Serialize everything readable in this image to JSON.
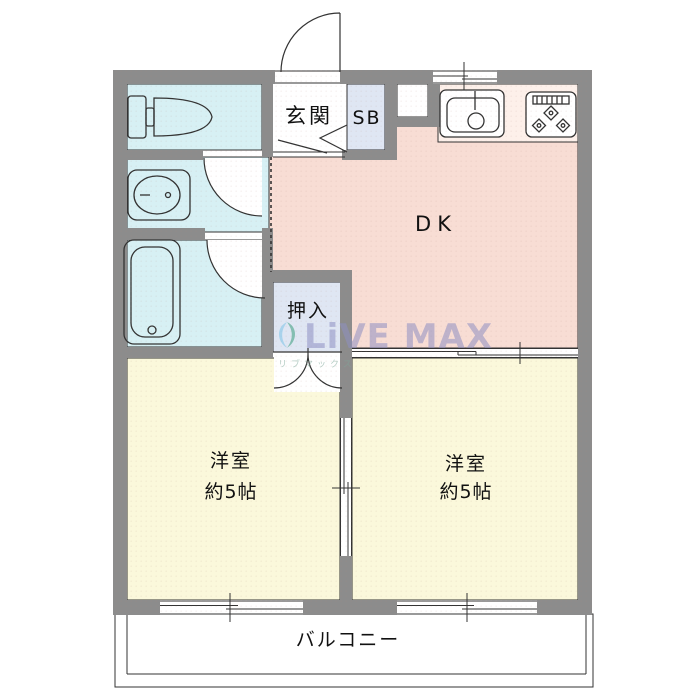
{
  "floorplan": {
    "title": "2DK apartment floor plan",
    "colors": {
      "wall": "#8c8c8c",
      "water_room": "#d7f0f4",
      "closet": "#dfe6f3",
      "dk": "#f8ddd4",
      "kitchen_counter": "#fdf0ea",
      "bedroom": "#fbf8db",
      "balcony": "#ffffff",
      "line": "#333333",
      "watermark_text": "#8f90c2",
      "watermark_leaf_green": "#3a9e7d",
      "watermark_leaf_blue": "#7ec4e8"
    },
    "rooms": {
      "entrance": {
        "label": "玄関"
      },
      "shoe_box": {
        "label": "SB"
      },
      "dining_kitchen": {
        "label": "DK"
      },
      "closet": {
        "label": "押入"
      },
      "bedroom_left": {
        "label": "洋室",
        "size": "約5帖"
      },
      "bedroom_right": {
        "label": "洋室",
        "size": "約5帖"
      },
      "balcony": {
        "label": "バルコニー"
      }
    },
    "fixtures": {
      "toilet": "toilet-icon",
      "washbasin": "washbasin-icon",
      "bathtub": "bathtub-icon",
      "kitchen_sink": "kitchen-sink-icon",
      "gas_stove": "gas-stove-icon"
    },
    "watermark": {
      "brand": "LiVE MAX",
      "sub": "リブマックス"
    }
  }
}
